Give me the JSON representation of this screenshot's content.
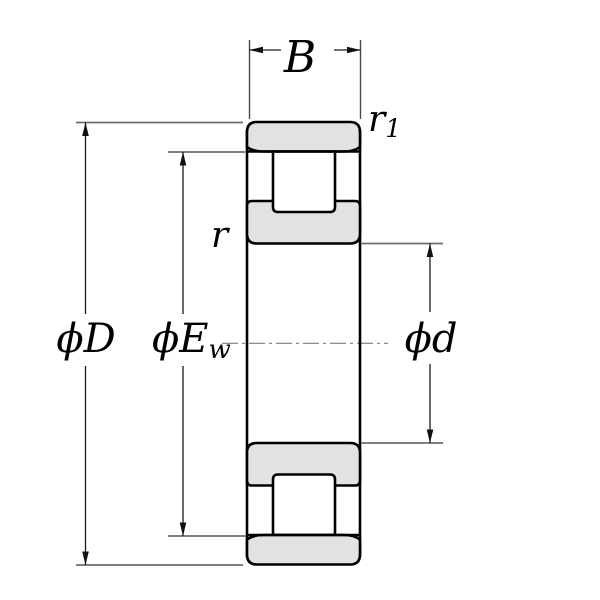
{
  "diagram": {
    "kind": "bearing-cross-section"
  },
  "dimensions": {
    "width": {
      "label": "B"
    },
    "outer_ring_chamfer": {
      "label": "r",
      "subscript": "1"
    },
    "inner_ring_chamfer": {
      "label": "r"
    },
    "outer_diameter": {
      "label": "ϕD"
    },
    "raceway_diameter": {
      "label": "ϕE",
      "subscript": "w"
    },
    "bore_diameter": {
      "label": "ϕd"
    }
  },
  "colors": {
    "background": "#ffffff",
    "ring_fill": "#e2e2e2",
    "roller_fill": "#ffffff",
    "outline": "#000000",
    "dimension_line": "#1a1a1a",
    "extension_line": "#6e6e6e",
    "centerline": "#7f7f7f"
  }
}
